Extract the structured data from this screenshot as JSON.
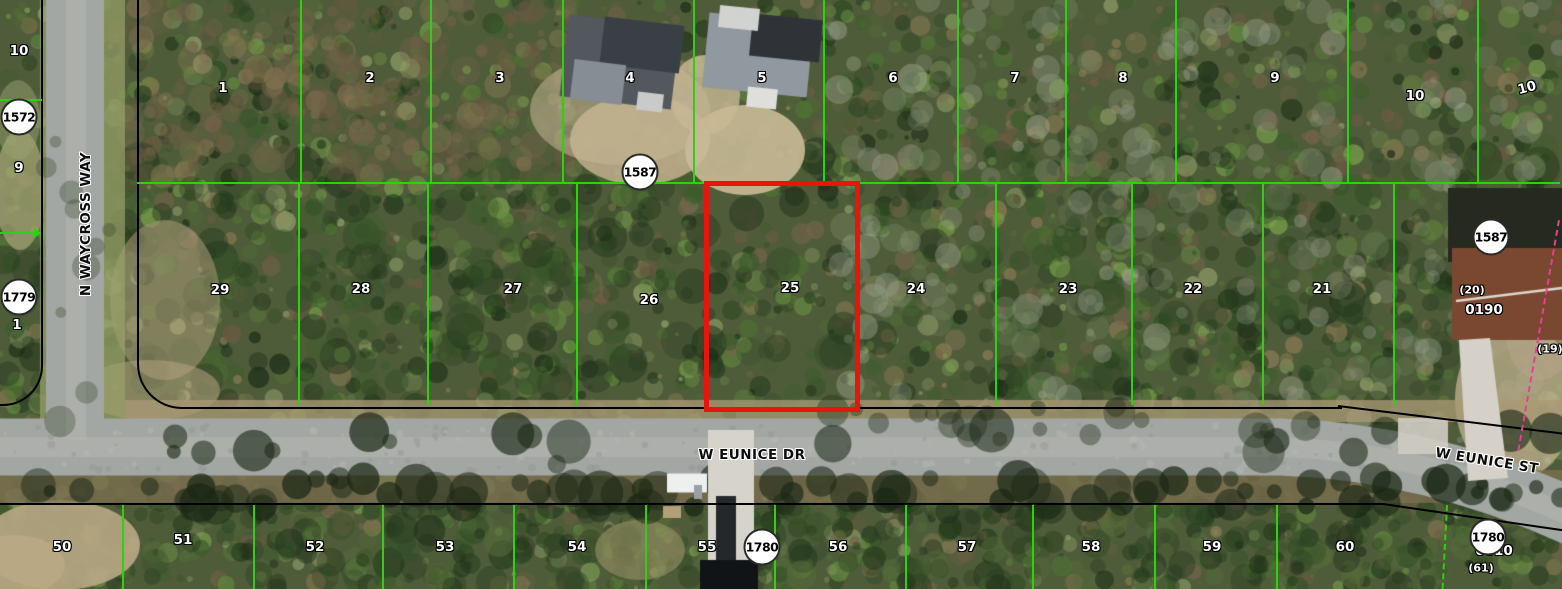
{
  "colors": {
    "parcel_line": "#2bd30a",
    "selected_parcel_outline": "#e8150c",
    "road_edge_line": "#000000",
    "survey_dashed_line": "#e83e93",
    "label_text_light": "#ffffff",
    "label_text_dark": "#0c0c0c",
    "circle_fill": "#ffffff"
  },
  "selected_parcel": {
    "lot": "25",
    "x": 704,
    "y": 181,
    "width": 146,
    "height": 221
  },
  "streets": [
    {
      "id": "n-waycross-way",
      "label": "N WAYCROSS WAY",
      "x": 86,
      "y": 224,
      "rotation": -90
    },
    {
      "id": "w-eunice-dr",
      "label": "W EUNICE DR",
      "x": 752,
      "y": 455,
      "rotation": 0
    },
    {
      "id": "w-eunice-st",
      "label": "W EUNICE ST",
      "x": 1487,
      "y": 461,
      "rotation": 9
    }
  ],
  "block_circles": [
    {
      "label": "1572",
      "x": 19,
      "y": 117
    },
    {
      "label": "1779",
      "x": 19,
      "y": 297
    },
    {
      "label": "1587",
      "x": 640,
      "y": 172
    },
    {
      "label": "1587",
      "x": 1491,
      "y": 237
    },
    {
      "label": "1780",
      "x": 762,
      "y": 547
    },
    {
      "label": "1780",
      "x": 1488,
      "y": 537
    }
  ],
  "lot_numbers": {
    "top_row": [
      {
        "n": "1",
        "x": 223,
        "y": 88
      },
      {
        "n": "2",
        "x": 370,
        "y": 78
      },
      {
        "n": "3",
        "x": 500,
        "y": 78
      },
      {
        "n": "4",
        "x": 630,
        "y": 78
      },
      {
        "n": "5",
        "x": 762,
        "y": 78
      },
      {
        "n": "6",
        "x": 893,
        "y": 78
      },
      {
        "n": "7",
        "x": 1015,
        "y": 78
      },
      {
        "n": "8",
        "x": 1123,
        "y": 78
      },
      {
        "n": "9",
        "x": 1275,
        "y": 78
      },
      {
        "n": "10",
        "x": 1415,
        "y": 96
      },
      {
        "n": "10",
        "x": 1527,
        "y": 88,
        "rotation": -15
      }
    ],
    "middle_row": [
      {
        "n": "29",
        "x": 220,
        "y": 290
      },
      {
        "n": "28",
        "x": 361,
        "y": 289
      },
      {
        "n": "27",
        "x": 513,
        "y": 289
      },
      {
        "n": "26",
        "x": 649,
        "y": 300
      },
      {
        "n": "25",
        "x": 790,
        "y": 288
      },
      {
        "n": "24",
        "x": 916,
        "y": 289
      },
      {
        "n": "23",
        "x": 1068,
        "y": 289
      },
      {
        "n": "22",
        "x": 1193,
        "y": 289
      },
      {
        "n": "21",
        "x": 1322,
        "y": 289
      }
    ],
    "bottom_row": [
      {
        "n": "50",
        "x": 62,
        "y": 547
      },
      {
        "n": "51",
        "x": 183,
        "y": 540
      },
      {
        "n": "52",
        "x": 315,
        "y": 547
      },
      {
        "n": "53",
        "x": 445,
        "y": 547
      },
      {
        "n": "54",
        "x": 577,
        "y": 547
      },
      {
        "n": "55",
        "x": 707,
        "y": 547
      },
      {
        "n": "56",
        "x": 838,
        "y": 547
      },
      {
        "n": "57",
        "x": 967,
        "y": 547
      },
      {
        "n": "58",
        "x": 1091,
        "y": 547
      },
      {
        "n": "59",
        "x": 1212,
        "y": 547
      },
      {
        "n": "60",
        "x": 1345,
        "y": 547
      }
    ],
    "left_column": [
      {
        "n": "10",
        "x": 19,
        "y": 51
      },
      {
        "n": "9",
        "x": 19,
        "y": 168
      },
      {
        "n": "1",
        "x": 17,
        "y": 325
      }
    ]
  },
  "annotations": [
    {
      "t": "(20)",
      "x": 1472,
      "y": 290,
      "kind": "paren"
    },
    {
      "t": "0190",
      "x": 1484,
      "y": 310,
      "kind": "code"
    },
    {
      "t": "(19)",
      "x": 1550,
      "y": 349,
      "kind": "paren"
    },
    {
      "t": "0610",
      "x": 1494,
      "y": 551,
      "kind": "code"
    },
    {
      "t": "(61)",
      "x": 1481,
      "y": 568,
      "kind": "paren"
    }
  ]
}
